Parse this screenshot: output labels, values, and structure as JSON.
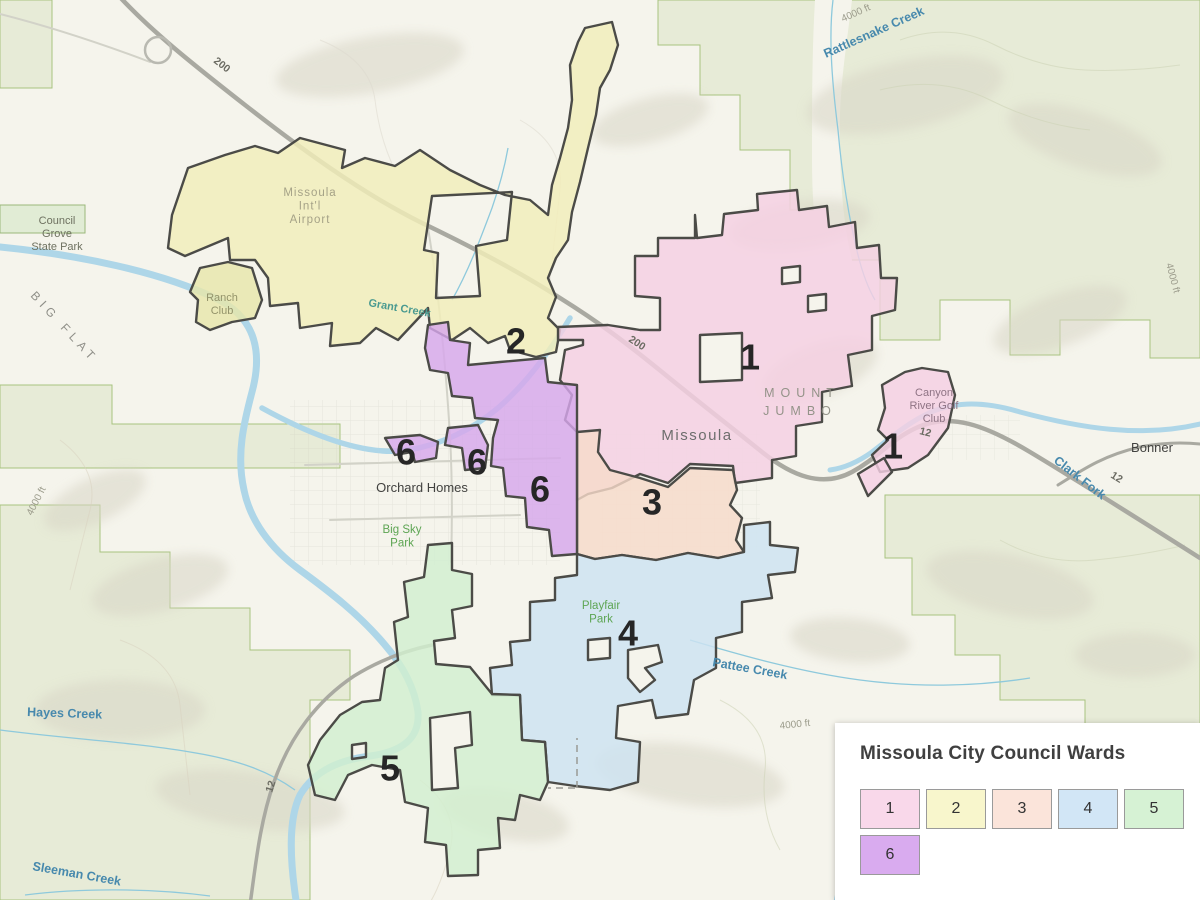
{
  "legend": {
    "title": "Missoula City Council Wards",
    "wards": [
      {
        "number": "1",
        "color": "#f9d8ea"
      },
      {
        "number": "2",
        "color": "#f8f6cc"
      },
      {
        "number": "3",
        "color": "#fbe4da"
      },
      {
        "number": "4",
        "color": "#d2e6f6"
      },
      {
        "number": "5",
        "color": "#d6f2d4"
      },
      {
        "number": "6",
        "color": "#d9abef"
      }
    ]
  },
  "map": {
    "ward_fills": {
      "1": "#f5cfe3",
      "2": "#f1eeb9",
      "3": "#f7dbc9",
      "4": "#cde3f2",
      "5": "#d2efcf",
      "6": "#d7a7ec"
    },
    "ward_outline": "#4b4b47",
    "ward_number_labels": [
      {
        "ward": "2",
        "x": 516,
        "y": 341
      },
      {
        "ward": "1",
        "x": 750,
        "y": 357
      },
      {
        "ward": "1",
        "x": 893,
        "y": 446
      },
      {
        "ward": "3",
        "x": 652,
        "y": 502
      },
      {
        "ward": "4",
        "x": 628,
        "y": 633
      },
      {
        "ward": "5",
        "x": 390,
        "y": 768
      },
      {
        "ward": "6",
        "x": 406,
        "y": 452
      },
      {
        "ward": "6",
        "x": 477,
        "y": 462
      },
      {
        "ward": "6",
        "x": 540,
        "y": 489
      }
    ],
    "labels": [
      {
        "text": "Council\nGrove\nState Park",
        "kind": "parkgray",
        "x": 57,
        "y": 224,
        "r": 0
      },
      {
        "text": "BIG FLAT",
        "kind": "flat",
        "x": 30,
        "y": 296,
        "r": 47
      },
      {
        "text": "Ranch\nClub",
        "kind": "ranch",
        "x": 222,
        "y": 301,
        "r": 0
      },
      {
        "text": "Missoula\nInt'l\nAirport",
        "kind": "area",
        "x": 310,
        "y": 196,
        "r": 0
      },
      {
        "text": "Grant Creek",
        "kind": "water-sm",
        "x": 368,
        "y": 306,
        "r": 10
      },
      {
        "text": "Rattlesnake Creek",
        "kind": "water",
        "x": 826,
        "y": 58,
        "r": -24
      },
      {
        "text": "4000 ft",
        "kind": "elev",
        "x": 843,
        "y": 22,
        "r": -24
      },
      {
        "text": "MOUNT",
        "kind": "mount",
        "x": 802,
        "y": 397,
        "r": 0
      },
      {
        "text": "JUMBO",
        "kind": "mount",
        "x": 800,
        "y": 415,
        "r": 0
      },
      {
        "text": "Missoula",
        "kind": "city",
        "x": 697,
        "y": 440,
        "r": 0
      },
      {
        "text": "Canyon\nRiver Golf\nClub",
        "kind": "golf",
        "x": 934,
        "y": 396,
        "r": 0
      },
      {
        "text": "Bonner",
        "kind": "place",
        "x": 1152,
        "y": 452,
        "r": 0
      },
      {
        "text": "Clark Fork",
        "kind": "water",
        "x": 1053,
        "y": 462,
        "r": 38
      },
      {
        "text": "4000 ft",
        "kind": "elev",
        "x": 1166,
        "y": 264,
        "r": 75
      },
      {
        "text": "Orchard Homes",
        "kind": "place",
        "x": 422,
        "y": 492,
        "r": 0
      },
      {
        "text": "Big Sky\nPark",
        "kind": "parks",
        "x": 402,
        "y": 533,
        "r": 0
      },
      {
        "text": "Playfair\nPark",
        "kind": "parks",
        "x": 601,
        "y": 609,
        "r": 0
      },
      {
        "text": "Pattee Creek",
        "kind": "water",
        "x": 712,
        "y": 666,
        "r": 10
      },
      {
        "text": "4000 ft",
        "kind": "elev",
        "x": 780,
        "y": 729,
        "r": -6
      },
      {
        "text": "4000 ft",
        "kind": "elev",
        "x": 32,
        "y": 516,
        "r": -63
      },
      {
        "text": "Hayes Creek",
        "kind": "water",
        "x": 27,
        "y": 716,
        "r": 2
      },
      {
        "text": "Sleeman Creek",
        "kind": "water",
        "x": 32,
        "y": 870,
        "r": 10
      },
      {
        "text": "200",
        "kind": "road",
        "x": 213,
        "y": 62,
        "r": 38
      },
      {
        "text": "200",
        "kind": "road",
        "x": 628,
        "y": 341,
        "r": 33
      },
      {
        "text": "12",
        "kind": "road",
        "x": 919,
        "y": 434,
        "r": 14
      },
      {
        "text": "12",
        "kind": "road",
        "x": 1110,
        "y": 477,
        "r": 32
      },
      {
        "text": "12",
        "kind": "road",
        "x": 272,
        "y": 793,
        "r": -72
      }
    ]
  }
}
